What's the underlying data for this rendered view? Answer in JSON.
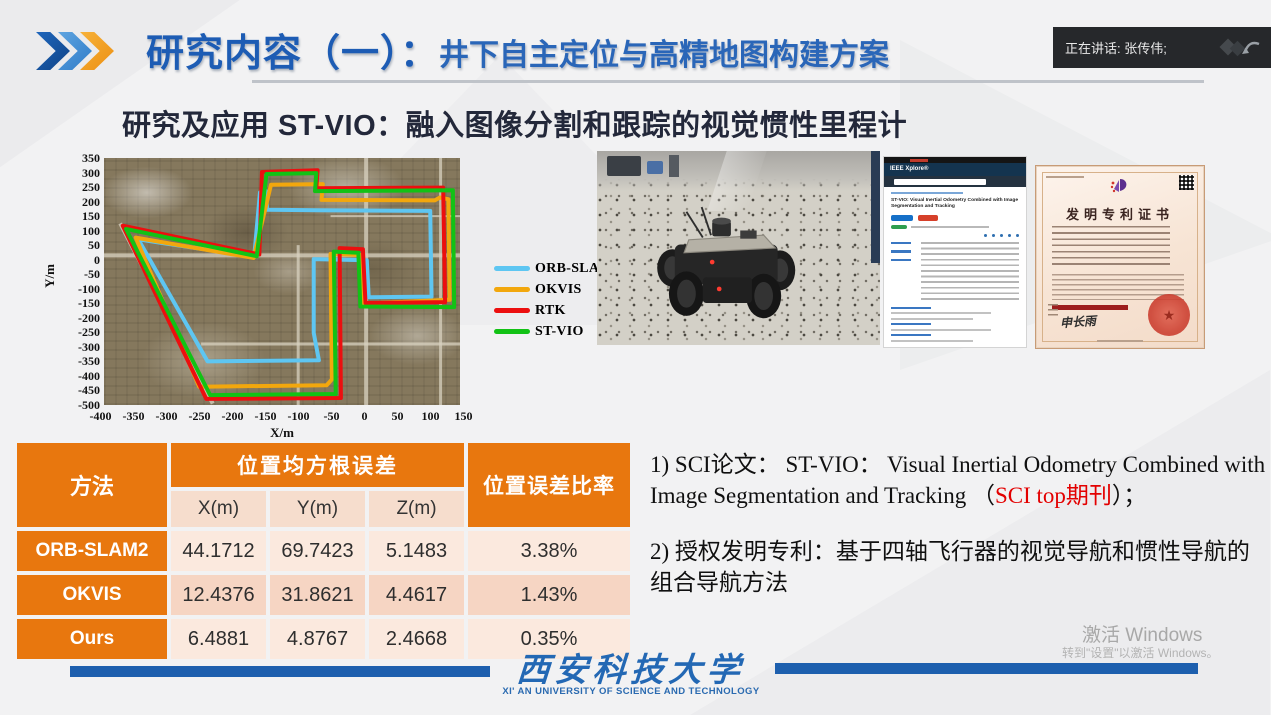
{
  "header": {
    "title_main": "研究内容（一）：",
    "title_sub": "井下自主定位与高精地图构建方案",
    "speaker_label": "正在讲话: 张传伟;"
  },
  "subtitle": "研究及应用 ST-VIO：融入图像分割和跟踪的视觉惯性里程计",
  "chart_data": {
    "type": "line",
    "title": "",
    "xlabel": "X/m",
    "ylabel": "Y/m",
    "xlim": [
      -400,
      150
    ],
    "ylim": [
      -500,
      350
    ],
    "x_ticks": [
      -400,
      -350,
      -300,
      -250,
      -200,
      -150,
      -100,
      -50,
      0,
      50,
      100,
      150
    ],
    "y_ticks": [
      350,
      300,
      250,
      200,
      150,
      100,
      50,
      0,
      -50,
      -100,
      -150,
      -200,
      -250,
      -300,
      -350,
      -400,
      -450,
      -500
    ],
    "grid": false,
    "legend_position": "right",
    "background": "satellite map of village streets",
    "series": [
      {
        "name": "ORB-SLAM2",
        "color": "#5ec6f2",
        "points": [
          [
            -168,
            10
          ],
          [
            -159,
            232
          ],
          [
            -150,
            236
          ],
          [
            -148,
            172
          ],
          [
            -70,
            170
          ],
          [
            104,
            168
          ],
          [
            106,
            -127
          ],
          [
            9,
            -129
          ],
          [
            6,
            -2
          ],
          [
            -76,
            2
          ],
          [
            -76,
            -252
          ],
          [
            -68,
            -346
          ],
          [
            -240,
            -350
          ],
          [
            -347,
            70
          ],
          [
            -168,
            10
          ]
        ]
      },
      {
        "name": "OKVIS",
        "color": "#f2a70d",
        "points": [
          [
            -169,
            6
          ],
          [
            -142,
            258
          ],
          [
            -62,
            260
          ],
          [
            -64,
            206
          ],
          [
            111,
            204
          ],
          [
            119,
            214
          ],
          [
            132,
            208
          ],
          [
            134,
            -138
          ],
          [
            -1,
            -151
          ],
          [
            -3,
            16
          ],
          [
            -50,
            20
          ],
          [
            -48,
            -412
          ],
          [
            -56,
            -432
          ],
          [
            -253,
            -437
          ],
          [
            -351,
            76
          ],
          [
            -169,
            6
          ]
        ]
      },
      {
        "name": "RTK",
        "color": "#ec0f0f",
        "points": [
          [
            -160,
            18
          ],
          [
            -156,
            302
          ],
          [
            -70,
            308
          ],
          [
            -72,
            246
          ],
          [
            124,
            248
          ],
          [
            127,
            -146
          ],
          [
            4,
            -149
          ],
          [
            0,
            36
          ],
          [
            -36,
            40
          ],
          [
            -34,
            -476
          ],
          [
            -242,
            -479
          ],
          [
            -371,
            117
          ],
          [
            -160,
            18
          ]
        ]
      },
      {
        "name": "ST-VIO",
        "color": "#12c215",
        "points": [
          [
            -164,
            12
          ],
          [
            -149,
            295
          ],
          [
            -72,
            298
          ],
          [
            -74,
            236
          ],
          [
            139,
            239
          ],
          [
            141,
            -163
          ],
          [
            -4,
            -161
          ],
          [
            -7,
            24
          ],
          [
            -45,
            28
          ],
          [
            -42,
            -462
          ],
          [
            -236,
            -466
          ],
          [
            -366,
            106
          ],
          [
            -164,
            12
          ]
        ]
      }
    ]
  },
  "table": {
    "col_method": "方法",
    "col_rmse": "位置均方根误差",
    "sub_cols": [
      "X(m)",
      "Y(m)",
      "Z(m)"
    ],
    "col_ratio": "位置误差比率",
    "rows": [
      {
        "method": "ORB-SLAM2",
        "x": "44.1712",
        "y": "69.7423",
        "z": "5.1483",
        "ratio": "3.38%"
      },
      {
        "method": "OKVIS",
        "x": "12.4376",
        "y": "31.8621",
        "z": "4.4617",
        "ratio": "1.43%"
      },
      {
        "method": "Ours",
        "x": "6.4881",
        "y": "4.8767",
        "z": "2.4668",
        "ratio": "0.35%"
      }
    ]
  },
  "achievements": {
    "item1_prefix": "1) SCI论文： ST-VIO： Visual Inertial Odometry Combined with Image Segmentation and Tracking （",
    "item1_red": "SCI top期刊",
    "item1_suffix": "）；",
    "item2": "2) 授权发明专利：基于四轴飞行器的视觉导航和惯性导航的组合导航方法"
  },
  "paper": {
    "site_label": "IEEE Xplore®",
    "title": "ST-VIO: Visual Inertial Odometry Combined with Image Segmentation and Tracking"
  },
  "patent": {
    "title": "发明专利证书",
    "signature": "申长雨"
  },
  "footer": {
    "university_cn": "西安科技大学",
    "university_en": "XI' AN UNIVERSITY  OF SCIENCE AND TECHNOLOGY"
  },
  "watermark": {
    "line1": "激活 Windows",
    "line2": "转到\"设置\"以激活 Windows。"
  }
}
